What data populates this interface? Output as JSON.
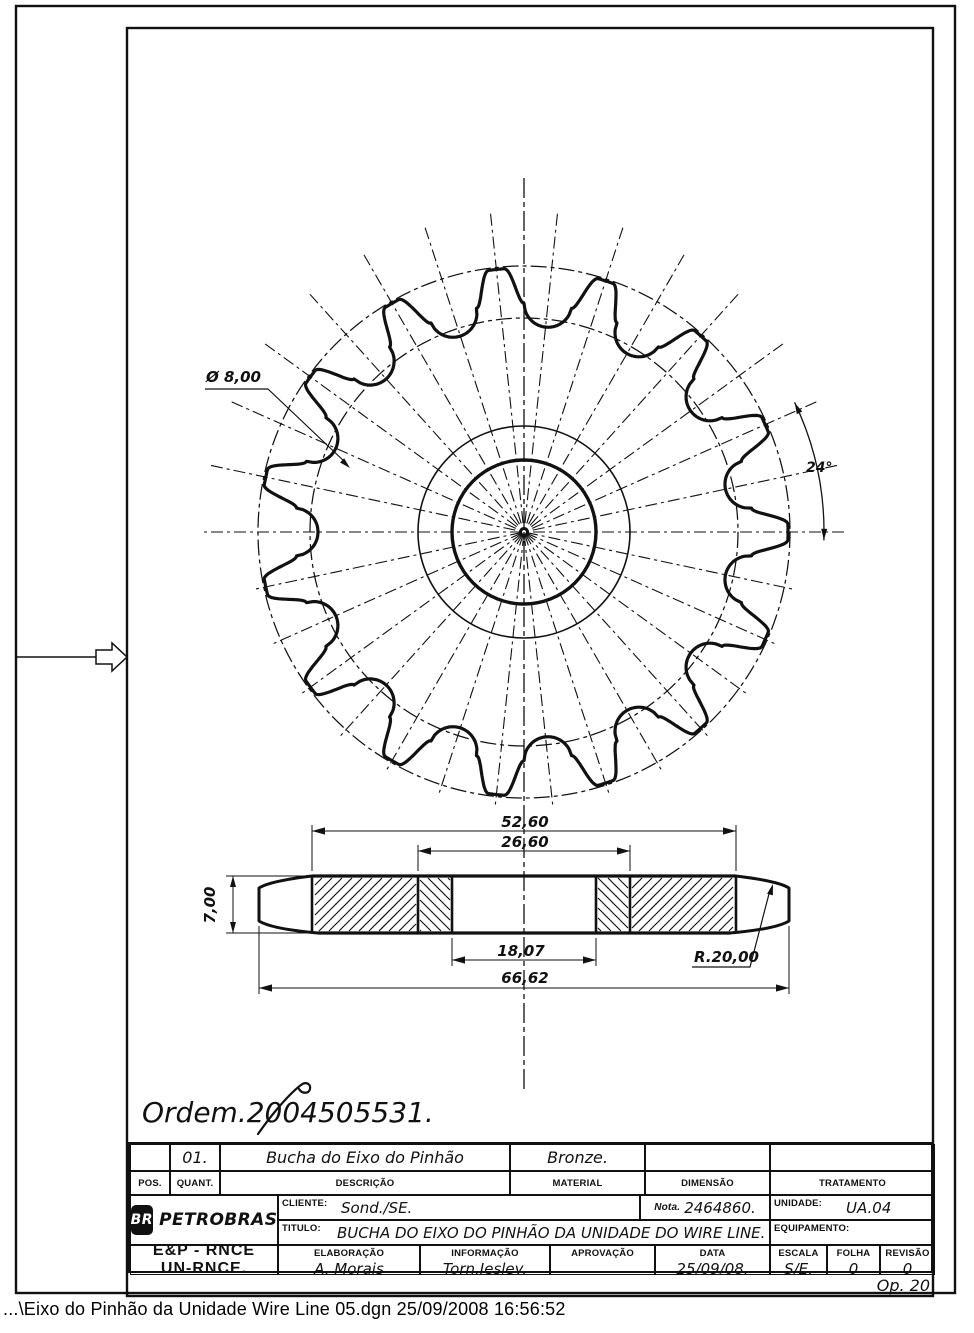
{
  "status_bar": {
    "text": "...\\Eixo do Pinhão da Unidade Wire Line 05.dgn  25/09/2008 16:56:52"
  },
  "annotations": {
    "order_note": "Ordem.2004505531.",
    "op_note": "Op. 20"
  },
  "drawing": {
    "front": {
      "hole_label": "Ø 8,00",
      "angle_label": "24°"
    },
    "section": {
      "dims": {
        "flange_width": "52,60",
        "hub_width": "26,60",
        "bore": "18,07",
        "overall": "66,62",
        "thickness": "7,00",
        "radius": "R.20,00"
      }
    }
  },
  "geometry": {
    "front": {
      "cx": 524,
      "cy": 532,
      "teeth": 15,
      "pitch_deg": 24,
      "phase_deg": 84,
      "tip_r": 264,
      "root_r": 206,
      "roller_r": 24,
      "tip_flat_deg": 1.7,
      "hub_r": 106,
      "bore_r": 72,
      "ref_circle_outer_r": 266,
      "ref_circle_inner_r": 214,
      "radial_up_r": 320,
      "radial_down_r": 278,
      "center_v_top": 178,
      "center_v_bottom": 1092,
      "angle_arc_r": 300,
      "angle_arc_from": -1.5,
      "angle_arc_to": 25.5
    },
    "section": {
      "cx": 524,
      "top": 876,
      "bottom": 933,
      "flat_l": 312,
      "flat_r": 736,
      "end_l": 259,
      "end_r": 789,
      "end_flat_top": 888,
      "end_flat_bot": 921,
      "hub_l": 418,
      "hub_r": 630,
      "bore_l": 452,
      "bore_r": 596,
      "dim_y_5260": 831,
      "dim_y_2660": 851,
      "dim_y_1807": 960,
      "dim_y_6662": 988,
      "thick_dim_x": 233,
      "ext_left": 226
    },
    "frame": {
      "outer": [
        16,
        6,
        939,
        1287
      ],
      "inner": [
        127,
        28,
        806,
        1268
      ],
      "pointer_y": 657
    }
  },
  "title_block": {
    "item_row": {
      "pos": "",
      "quant": "01.",
      "descricao": "Bucha do Eixo do Pinhão",
      "material": "Bronze.",
      "dimensao": "",
      "tratamento": ""
    },
    "headers": {
      "pos": "POS.",
      "quant": "QUANT.",
      "descricao": "DESCRIÇÃO",
      "material": "MATERIAL",
      "dimensao": "DIMENSÃO",
      "tratamento": "TRATAMENTO"
    },
    "cliente_label": "CLIENTE:",
    "cliente": "Sond./SE.",
    "nota_label": "Nota.",
    "nota": "2464860.",
    "unidade_label": "UNIDADE:",
    "unidade": "UA.04",
    "titulo_label": "TITULO:",
    "titulo": "BUCHA DO EIXO DO PINHÃO DA UNIDADE DO WIRE LINE.",
    "equipamento_label": "EQUIPAMENTO:",
    "org_line1": "E&P - RNCE",
    "org_line2": "UN-RNCE.",
    "logo": {
      "mark": "BR",
      "brand": "PETROBRAS"
    },
    "elaboracao_label": "ELABORAÇÃO",
    "elaboracao": "A. Morais",
    "informacao_label": "INFORMAÇÃO",
    "informacao": "Torn.Jesley.",
    "aprovacao_label": "APROVAÇÃO",
    "aprovacao": "",
    "data_label": "DATA",
    "data": "25/09/08.",
    "escala_label": "ESCALA",
    "escala": "S/E.",
    "folha_label": "FOLHA",
    "folha": "0",
    "revisao_label": "REVISÃO",
    "revisao": "0"
  }
}
